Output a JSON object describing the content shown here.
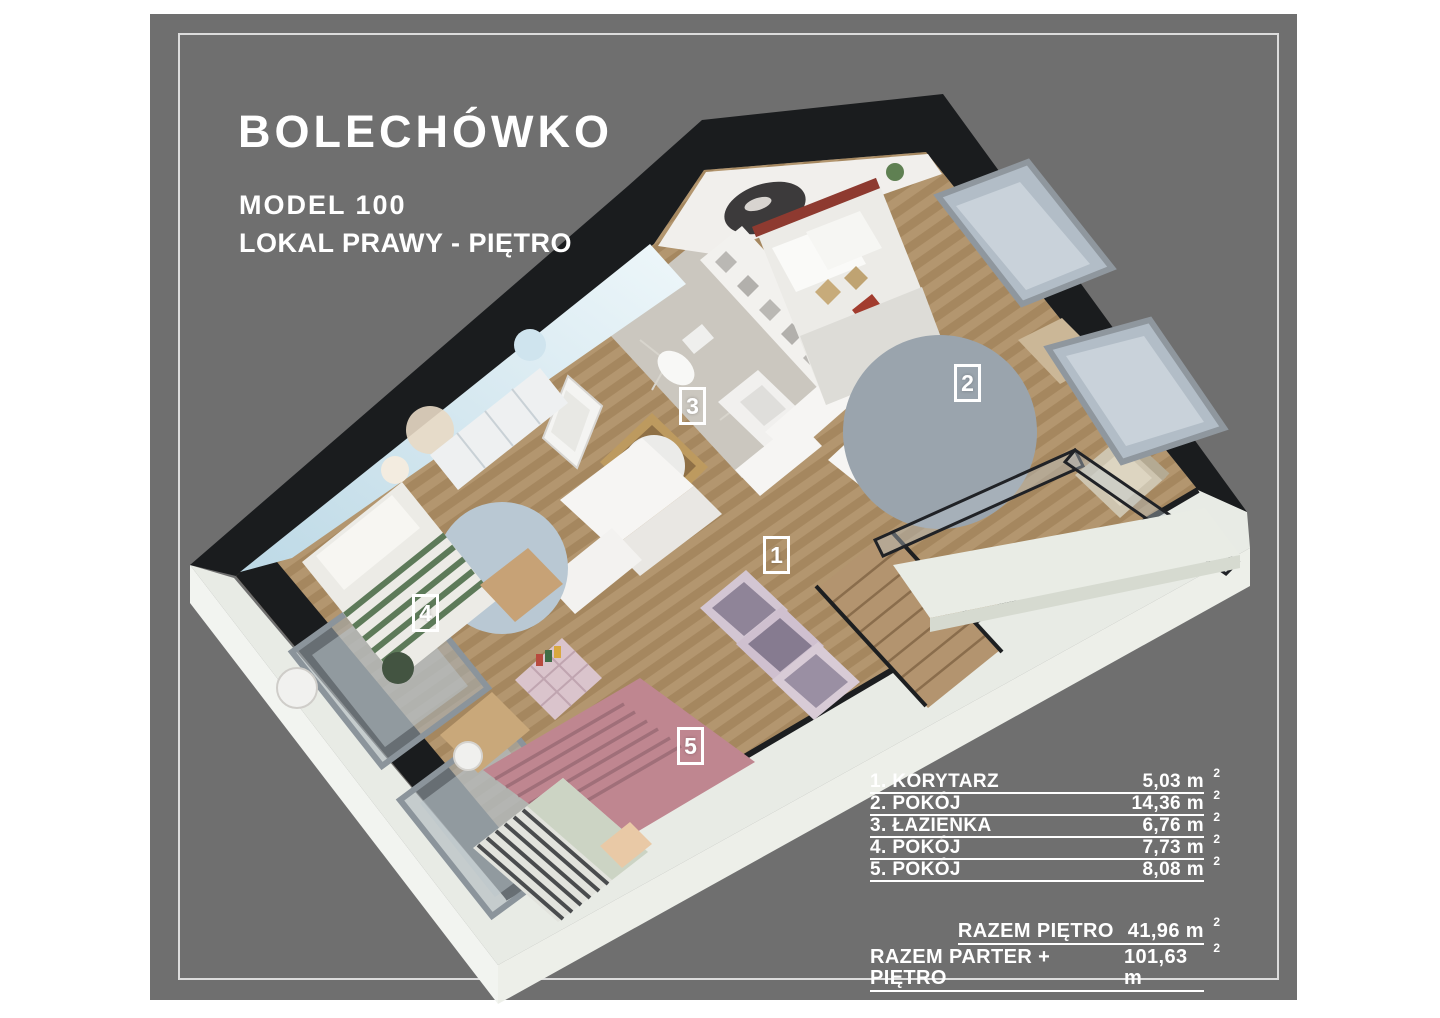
{
  "header": {
    "project": "BOLECHÓWKO",
    "model": "MODEL 100",
    "unit": "LOKAL PRAWY - PIĘTRO"
  },
  "plan": {
    "labels": [
      "1",
      "2",
      "3",
      "4",
      "5"
    ]
  },
  "legend": {
    "sup": "2",
    "items": [
      {
        "label": "1. KORYTARZ",
        "value": "5,03 m"
      },
      {
        "label": "2. POKÓJ",
        "value": "14,36 m"
      },
      {
        "label": "3. ŁAZIENKA",
        "value": "6,76 m"
      },
      {
        "label": "4. POKÓJ",
        "value": "7,73 m"
      },
      {
        "label": "5. POKÓJ",
        "value": "8,08 m"
      }
    ]
  },
  "totals": {
    "sup": "2",
    "items": [
      {
        "label": "RAZEM PIĘTRO",
        "value": "41,96 m"
      },
      {
        "label": "RAZEM PARTER + PIĘTRO",
        "value": "101,63 m"
      }
    ]
  },
  "colors": {
    "panel_background": "#6f6f6f",
    "frame_border": "#dcdcdc",
    "text": "#ffffff",
    "roof_cut": "#1a1c1e",
    "exterior_wall_cut": "#e8ebe5",
    "wood_floor": "#b3966f"
  }
}
